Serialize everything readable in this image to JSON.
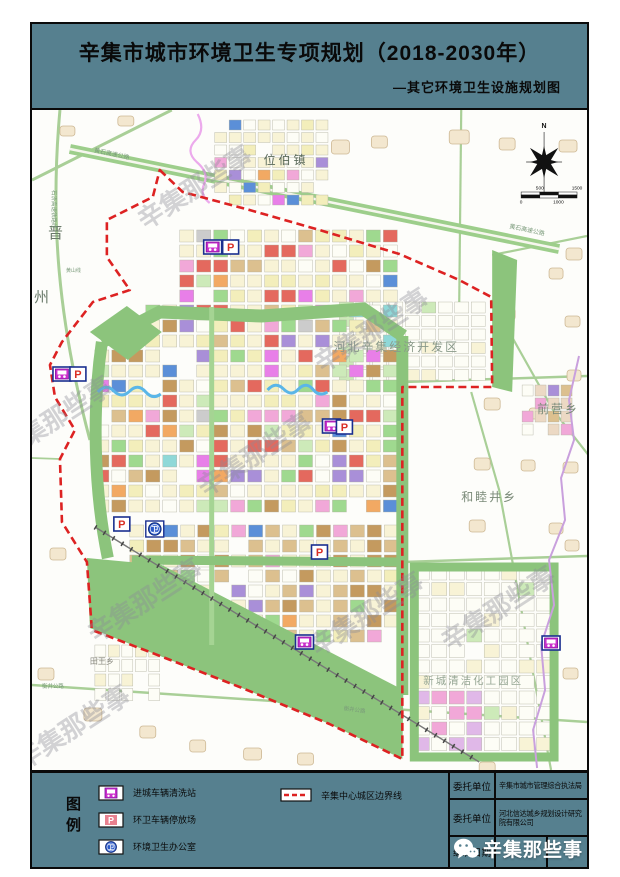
{
  "header": {
    "title": "辛集市城市环境卫生专项规划（2018-2030年）",
    "subtitle": "—其它环境卫生设施规划图"
  },
  "map": {
    "north_label": "N",
    "watermark": "辛集那些事",
    "scalebar": [
      "0",
      "500",
      "1000",
      "1500"
    ],
    "labels": {
      "weibozhen": "位伯镇",
      "jin": "晋",
      "zhou": "州",
      "kaifaqu": "河北辛集经济开发区",
      "qianyingxiang": "前营乡",
      "hemujingxiang": "和睦井乡",
      "huagongyuanqu": "新城清洁化工园区",
      "tianwangxiang": "田王乡",
      "road_rail": "石济高速铁路线",
      "road_huangshi": "黄石高速公路",
      "road_huangshan": "黄山线",
      "road_hengjing": "衡井公路"
    },
    "icon_glyphs": {
      "parking": "P",
      "office": "卫"
    }
  },
  "legend": {
    "title": "图例",
    "items": [
      {
        "label": "进城车辆清洗站"
      },
      {
        "label": "环卫车辆停放场"
      },
      {
        "label": "环境卫生办公室"
      }
    ],
    "boundary_label": "辛集中心城区边界线"
  },
  "titleblock": {
    "rows": [
      {
        "label": "委托单位",
        "value": "辛集市城市管理综合执法局"
      },
      {
        "label": "委托单位",
        "value": "河北信达城乡规划设计研究院有限公司"
      },
      {
        "label": "编制日期",
        "value": ""
      }
    ]
  },
  "footer_logo": {
    "text": "辛集那些事"
  },
  "colors": {
    "panel_bg": "#56808F",
    "boundary_red": "#DD2222",
    "wash_magenta": "#CC2FCC",
    "office_blue": "#2B59C8",
    "belt_green": "#8CC47C"
  }
}
